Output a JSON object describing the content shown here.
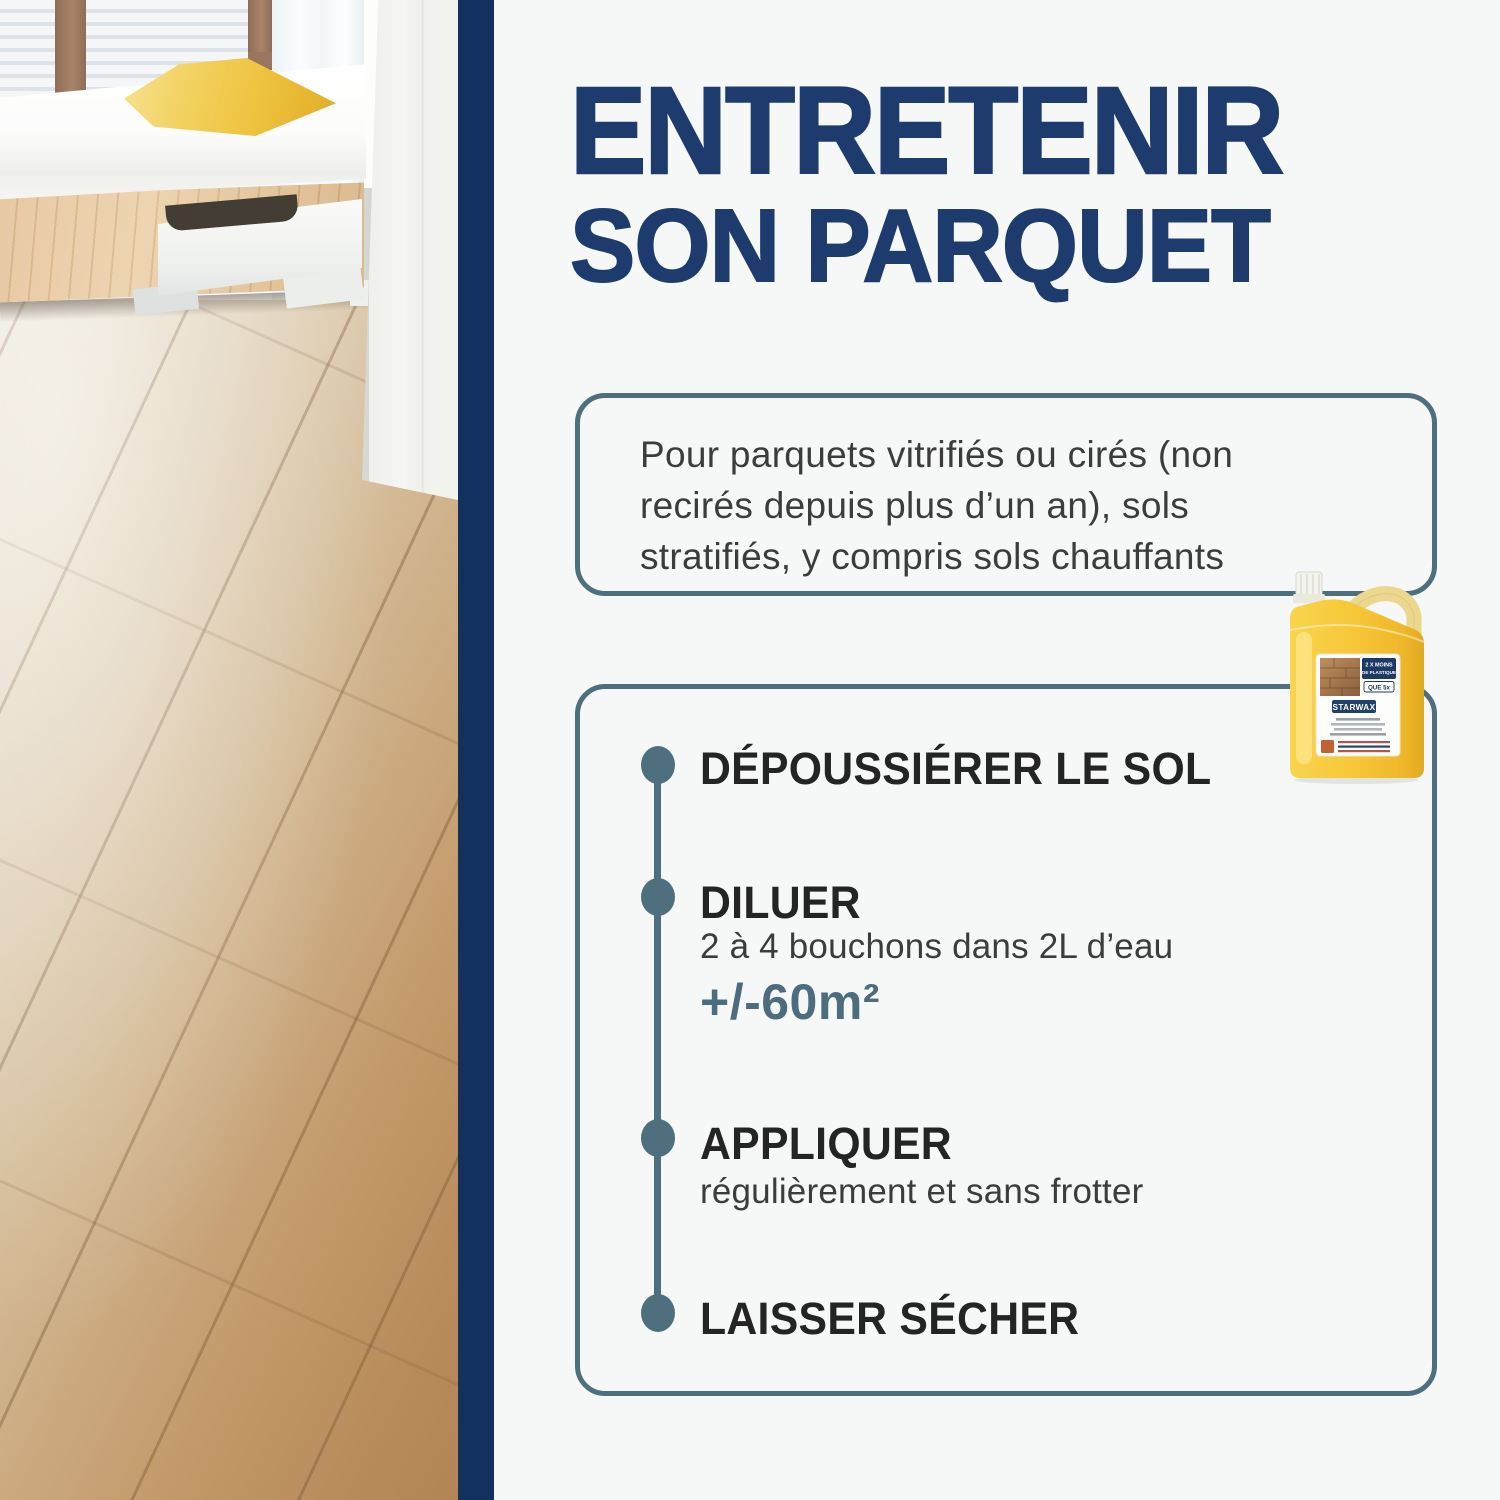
{
  "colors": {
    "navy_bar": "#12315e",
    "title_navy": "#1d3c6d",
    "slate_accent": "#4e6f7e",
    "step_title": "#242424",
    "body_text": "#3c3c3c",
    "background": "#f6f7f7",
    "product_yellow": "#f6c637"
  },
  "title": {
    "line1": "ENTRETENIR",
    "line2": "SON PARQUET"
  },
  "intro_box": {
    "lines": [
      "Pour parquets vitrifiés ou cirés (non",
      "recirés depuis plus d’un an), sols",
      "stratifiés, y compris sols chauffants"
    ]
  },
  "steps": [
    {
      "title": "DÉPOUSSIÉRER LE SOL"
    },
    {
      "title": "DILUER",
      "detail": "2 à 4 bouchons dans 2L d’eau",
      "highlight": "+/-60m²"
    },
    {
      "title": "APPLIQUER",
      "detail": "régulièrement et sans frotter"
    },
    {
      "title": "LAISSER SÉCHER"
    }
  ],
  "product": {
    "brand": "STARWAX",
    "badge_line1": "2 X MOINS",
    "badge_line2": "DE PLASTIQUE",
    "badge_line3": "QUE 5x"
  }
}
